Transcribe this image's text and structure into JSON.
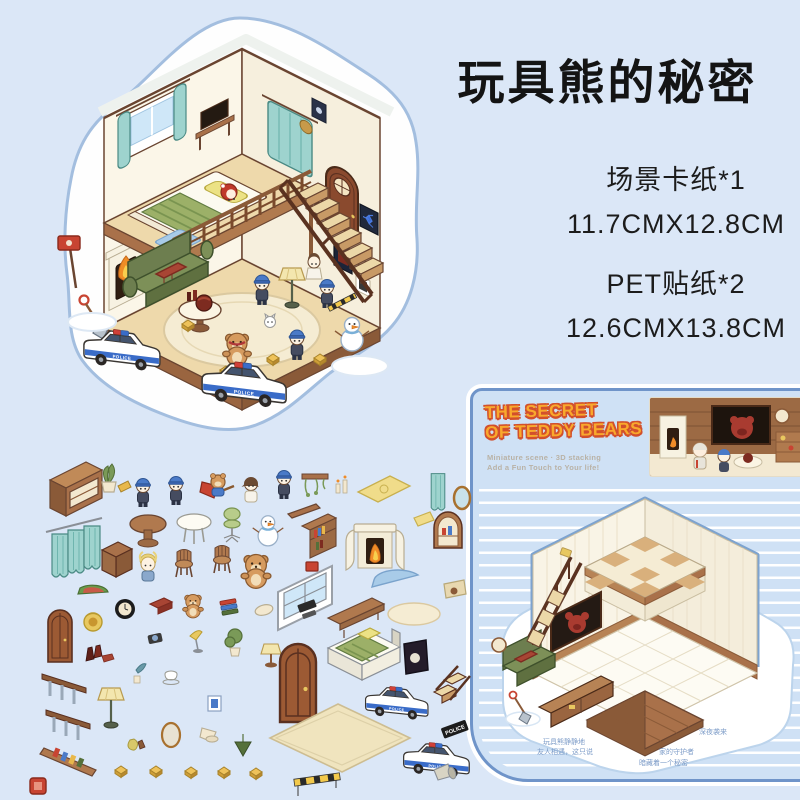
{
  "page": {
    "background": "#dbe7f7",
    "title": "玩具熊的秘密"
  },
  "specs": {
    "line1": "场景卡纸*1",
    "line2": "11.7CMX12.8CM",
    "line3": "PET贴纸*2",
    "line4": "12.6CMX13.8CM"
  },
  "card": {
    "title_line1": "THE SECRET",
    "title_line2": "OF TEDDY BEARS",
    "subtitle_line1": "Miniature scene · 3D stacking",
    "subtitle_line2": "Add a Fun Touch to Your life!",
    "notes": [
      "玩具熊静静地",
      "友人相遇，这只说",
      "深夜袭来",
      "家的守护者",
      "暗藏着一个秘密"
    ]
  },
  "scene": {
    "police_label": "POLICE"
  },
  "colors": {
    "background": "#dbe7f7",
    "card_blue": "#cfe1f5",
    "card_border": "#6f94c9",
    "accent_orange": "#f9a92c",
    "outline_red": "#d2502c",
    "teal_curtain": "#9ed3ce",
    "wood": "#a9714a",
    "police_blue": "#3a6cc8",
    "wall_cream": "#fbf6e8",
    "floor_tan": "#eed9ab",
    "tv_red_bear": "#a93b30",
    "sofa_green": "#7d9058"
  },
  "stickers": {
    "items": [
      "display-cabinet",
      "potted-plant",
      "police-officer",
      "police-officer-2",
      "superhero-bear",
      "girl-villager",
      "police-officer-3",
      "hanging-vine-shelf",
      "candle-pair",
      "yellow-mat",
      "curtain-single",
      "oval-mirror",
      "curtain-triple",
      "wooden-crate",
      "round-table",
      "white-table",
      "desk-chair-green",
      "blonde-kid",
      "wood-chair",
      "wood-chair-2",
      "snowman",
      "shelf-plank",
      "mini-bookshelf",
      "watermelon",
      "teddy-bear",
      "window-frame",
      "fireplace",
      "envelope",
      "arch-display",
      "blue-half-rug",
      "poster",
      "oval-tray",
      "game-console",
      "bench",
      "cream-rug",
      "arched-door-small",
      "lion-plaque",
      "wall-clock",
      "red-cushion",
      "teddy-mini",
      "book-stack",
      "wine-bottles",
      "stair-railing",
      "stair-railing-2",
      "floor-lamp",
      "toothbrush-cup",
      "teacup",
      "camera",
      "desk-lamp",
      "potted-tree",
      "small-frame",
      "oval-mirror-2",
      "cone-lamp",
      "pear-bottle",
      "book-ledge",
      "evidence-marker",
      "table-lamp",
      "arched-door-big",
      "bed",
      "dark-frame",
      "police-car",
      "wooden-stairs",
      "big-rug",
      "police-car-2",
      "police-sign",
      "caution-barrier",
      "red-seal",
      "hanging-plant",
      "megaphone"
    ]
  }
}
